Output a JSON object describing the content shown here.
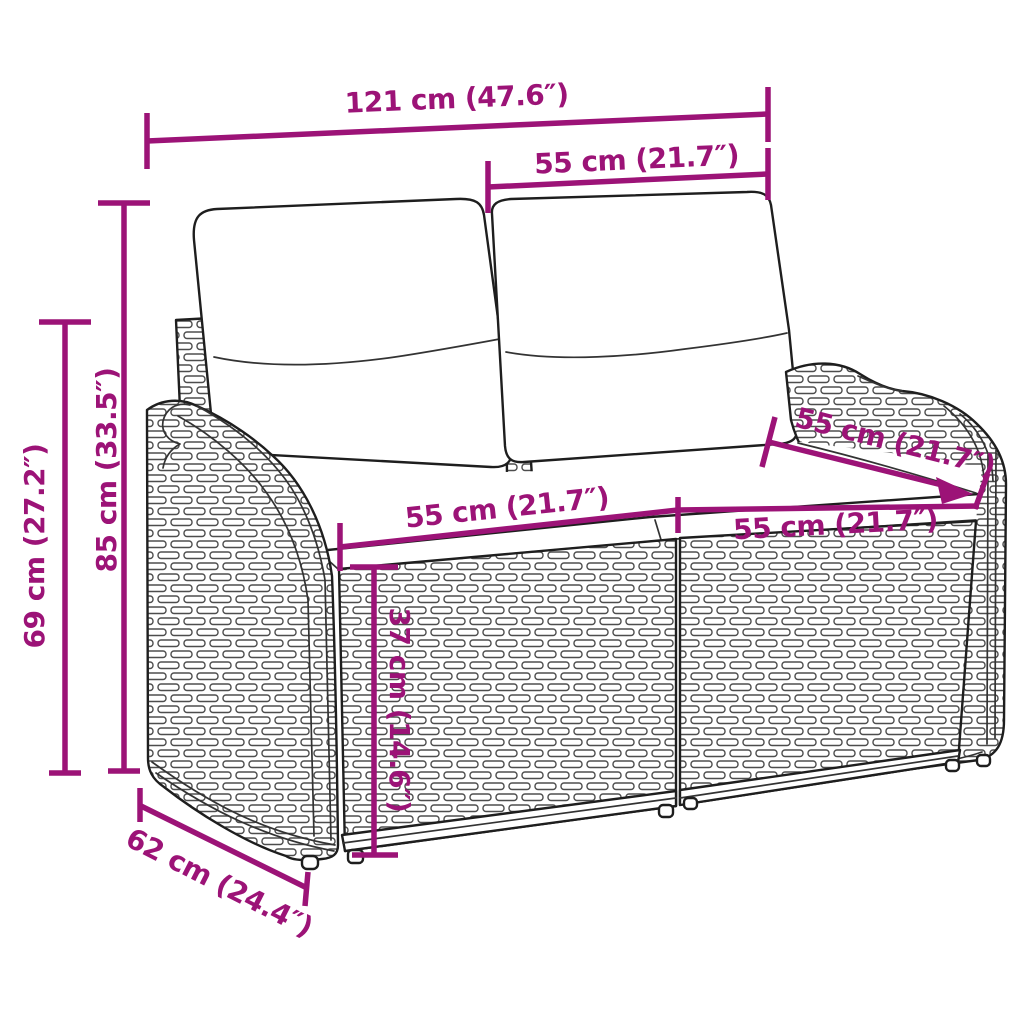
{
  "diagram": {
    "annotation_color": "#9C1377",
    "dimensions": {
      "overall_width": "121 cm (47.6″)",
      "backrest_section_width": "55 cm (21.7″)",
      "total_height": "85 cm (33.5″)",
      "armrest_height": "69 cm (27.2″)",
      "base_depth": "62 cm (24.4″)",
      "seat_width_left": "55 cm (21.7″)",
      "seat_width_right": "55 cm (21.7″)",
      "seat_depth": "55 cm (21.7″)",
      "seat_height": "37 cm (14.6″)"
    }
  }
}
